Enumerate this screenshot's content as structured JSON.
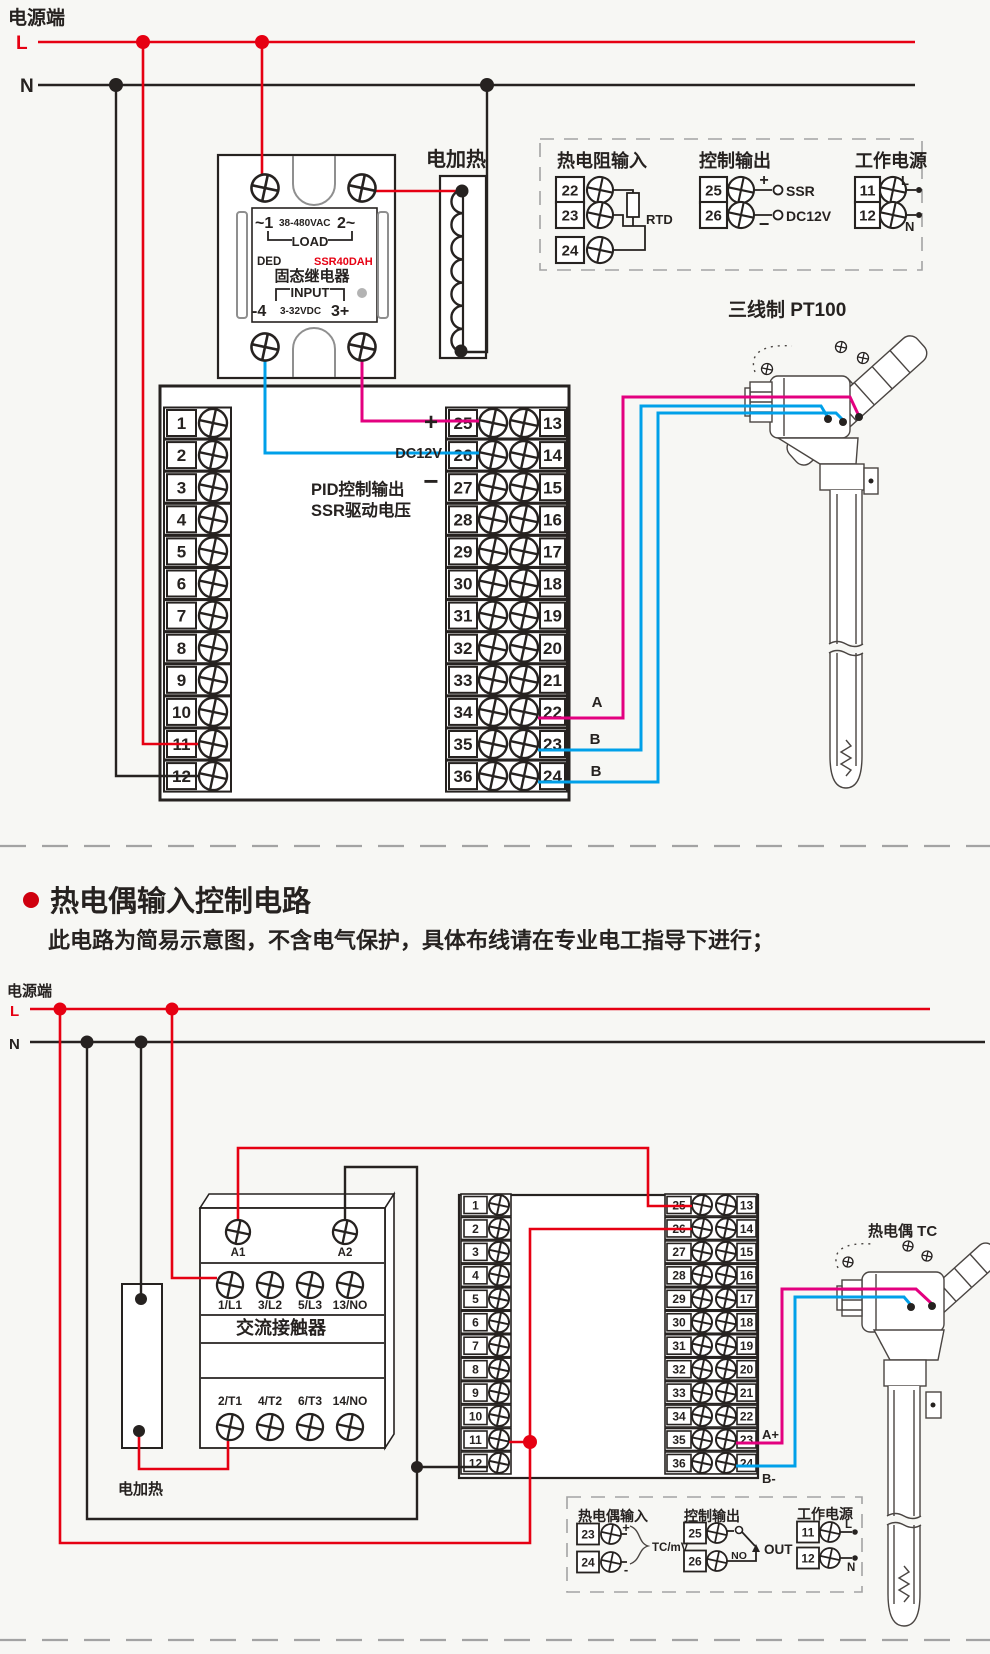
{
  "colors": {
    "live_wire": "#e60012",
    "neutral_wire": "#262220",
    "signal_a_wire": "#e3007f",
    "signal_b_wire": "#00a0e9",
    "ssr_model_text": "#e60012",
    "background": "#f7f7f4"
  },
  "top": {
    "power_label": "电源端",
    "l": "L",
    "n": "N",
    "heater": "电加热",
    "ssr": {
      "l1a": "~1",
      "l1b": "38-480VAC",
      "l1c": "2~",
      "load": "LOAD",
      "ded": "DED",
      "model": "SSR40DAH",
      "name": "固态继电器",
      "input": "INPUT",
      "l6a": "-4",
      "l6b": "3-32VDC",
      "l6c": "3+"
    },
    "io": {
      "rtd": {
        "title": "热电阻输入",
        "terms": [
          "22",
          "23",
          "24"
        ],
        "label": "RTD"
      },
      "out": {
        "title": "控制输出",
        "terms": [
          "25",
          "26"
        ],
        "plus": "+",
        "minus": "−",
        "ssr": "SSR",
        "dc": "DC12V"
      },
      "pwr": {
        "title": "工作电源",
        "terms": [
          "11",
          "12"
        ],
        "l": "L",
        "n": "N"
      }
    },
    "block": {
      "left": [
        "1",
        "2",
        "3",
        "4",
        "5",
        "6",
        "7",
        "8",
        "9",
        "10",
        "11",
        "12"
      ],
      "mid": [
        "25",
        "26",
        "27",
        "28",
        "29",
        "30",
        "31",
        "32",
        "33",
        "34",
        "35",
        "36"
      ],
      "right": [
        "13",
        "14",
        "15",
        "16",
        "17",
        "18",
        "19",
        "20",
        "21",
        "22",
        "23",
        "24"
      ],
      "plus": "+",
      "dc": "DC12V",
      "minus": "−",
      "pid1": "PID控制输出",
      "pid2": "SSR驱动电压",
      "a": "A",
      "b1": "B",
      "b2": "B"
    },
    "sensor": "三线制 PT100"
  },
  "section": {
    "title": "热电偶输入控制电路",
    "subtitle": "此电路为简易示意图，不含电气保护，具体布线请在专业电工指导下进行；"
  },
  "bottom": {
    "power_label": "电源端",
    "l": "L",
    "n": "N",
    "heater": "电加热",
    "contactor": {
      "a1": "A1",
      "a2": "A2",
      "row1": [
        "1/L1",
        "3/L2",
        "5/L3",
        "13/NO"
      ],
      "name": "交流接触器",
      "row2": [
        "2/T1",
        "4/T2",
        "6/T3",
        "14/NO"
      ]
    },
    "block": {
      "left": [
        "1",
        "2",
        "3",
        "4",
        "5",
        "6",
        "7",
        "8",
        "9",
        "10",
        "11",
        "12"
      ],
      "mid": [
        "25",
        "26",
        "27",
        "28",
        "29",
        "30",
        "31",
        "32",
        "33",
        "34",
        "35",
        "36"
      ],
      "right": [
        "13",
        "14",
        "15",
        "16",
        "17",
        "18",
        "19",
        "20",
        "21",
        "22",
        "23",
        "24"
      ],
      "aplus": "A+",
      "bminus": "B-"
    },
    "sensor": "热电偶 TC",
    "io": {
      "tc": {
        "title": "热电偶输入",
        "terms": [
          "23",
          "24"
        ],
        "plus": "+",
        "minus": "-",
        "label": "TC/mV"
      },
      "out": {
        "title": "控制输出",
        "terms": [
          "25",
          "26"
        ],
        "no": "NO",
        "out": "OUT"
      },
      "pwr": {
        "title": "工作电源",
        "terms": [
          "11",
          "12"
        ],
        "l": "L",
        "n": "N"
      }
    }
  }
}
